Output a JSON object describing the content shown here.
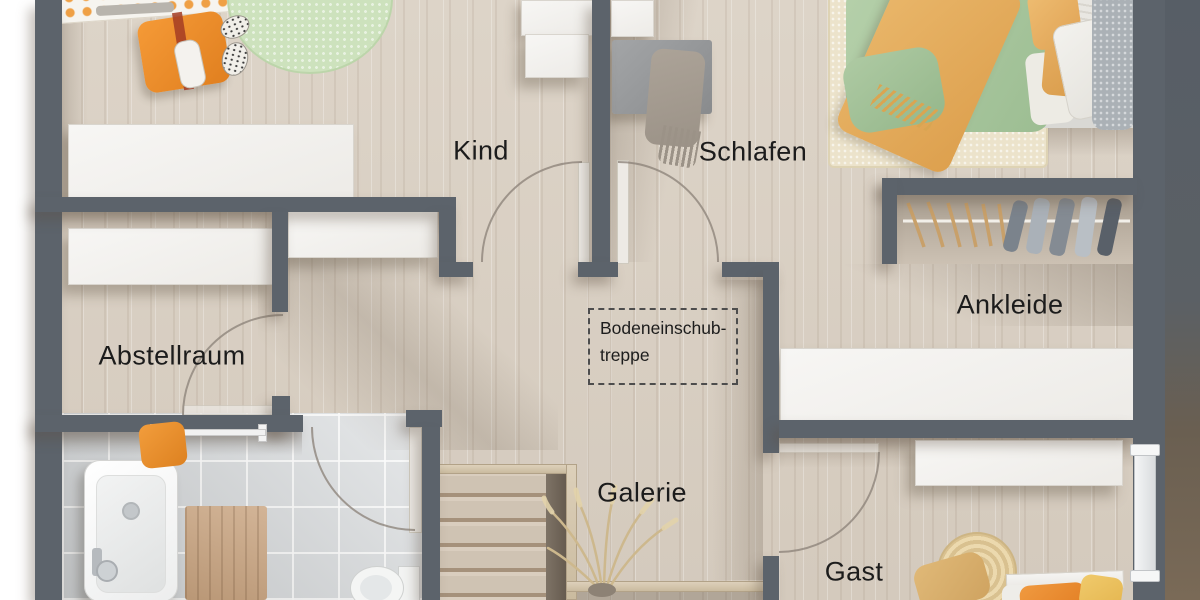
{
  "rooms": {
    "kind": {
      "label": "Kind"
    },
    "schlafen": {
      "label": "Schlafen"
    },
    "ankleide": {
      "label": "Ankleide"
    },
    "abstellraum": {
      "label": "Abstellraum"
    },
    "galerie": {
      "label": "Galerie"
    },
    "gast": {
      "label": "Gast"
    }
  },
  "attic_hatch": {
    "line1": "Bodeneinschub-",
    "line2": "treppe"
  },
  "colors": {
    "wall": "#5c636b",
    "wood_floor": "#d8cfc3",
    "bath_tile": "#d2d6d9",
    "label_text": "#1c1c1c",
    "accent_orange": "#ee8f33",
    "accent_mustard": "#e3aa5e",
    "accent_green": "#a9c79f",
    "rug_green": "#cde2bd",
    "rug_cream": "#ece3cb",
    "stair_wood": "#cfc3b3"
  }
}
